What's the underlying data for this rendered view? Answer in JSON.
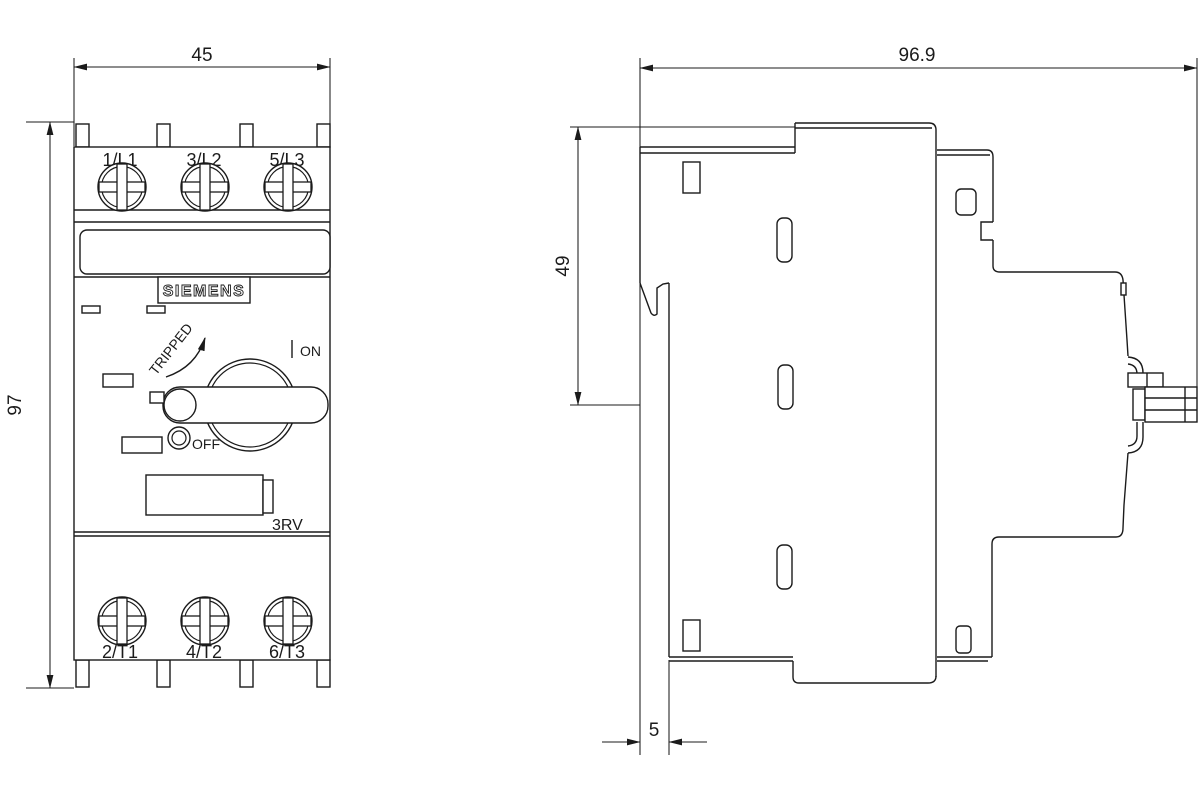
{
  "front": {
    "brand": "SIEMENS",
    "series": "3RV",
    "top_terminals": [
      "1/L1",
      "3/L2",
      "5/L3"
    ],
    "bottom_terminals": [
      "2/T1",
      "4/T2",
      "6/T3"
    ],
    "tripped": "TRIPPED",
    "on": "ON",
    "off": "OFF"
  },
  "dims": {
    "width": "45",
    "height": "97",
    "depth": "96.9",
    "top_to_axis": "49",
    "offset": "5"
  },
  "colors": {
    "line": "#1b1b1b",
    "bg": "#ffffff"
  }
}
